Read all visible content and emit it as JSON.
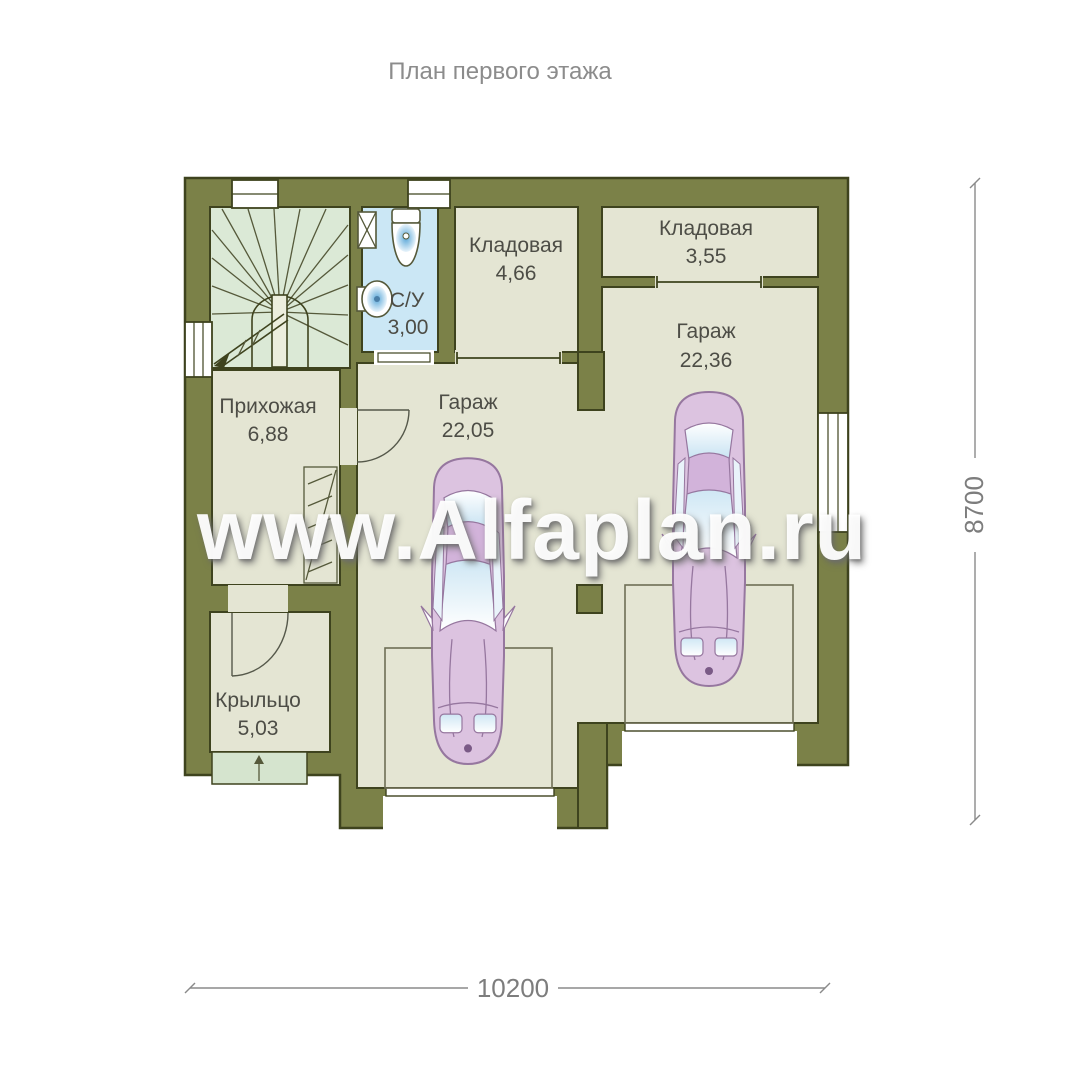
{
  "title": "План первого этажа",
  "watermark": "www.Alfaplan.ru",
  "rooms": {
    "bathroom": {
      "name": "С/У",
      "area": "3,00"
    },
    "storage1": {
      "name": "Кладовая",
      "area": "4,66"
    },
    "storage2": {
      "name": "Кладовая",
      "area": "3,55"
    },
    "garage1": {
      "name": "Гараж",
      "area": "22,05"
    },
    "garage2": {
      "name": "Гараж",
      "area": "22,36"
    },
    "hallway": {
      "name": "Прихожая",
      "area": "6,88"
    },
    "porch": {
      "name": "Крыльцо",
      "area": "5,03"
    }
  },
  "dimensions": {
    "width": "10200",
    "height": "8700"
  },
  "colors": {
    "wall": "#7b8148",
    "wall_outline": "#3e431e",
    "floor": "#e4e5d3",
    "stairs_floor": "#dbe9d6",
    "bathroom_floor": "#cbe7f5",
    "porch_steps": "#d5e4ce",
    "car_body": "#dcc3e0",
    "car_outline": "#96779f",
    "label_text": "#4d4d46",
    "dimension_text": "#7d7d7d",
    "watermark_text": "#ffffff"
  }
}
